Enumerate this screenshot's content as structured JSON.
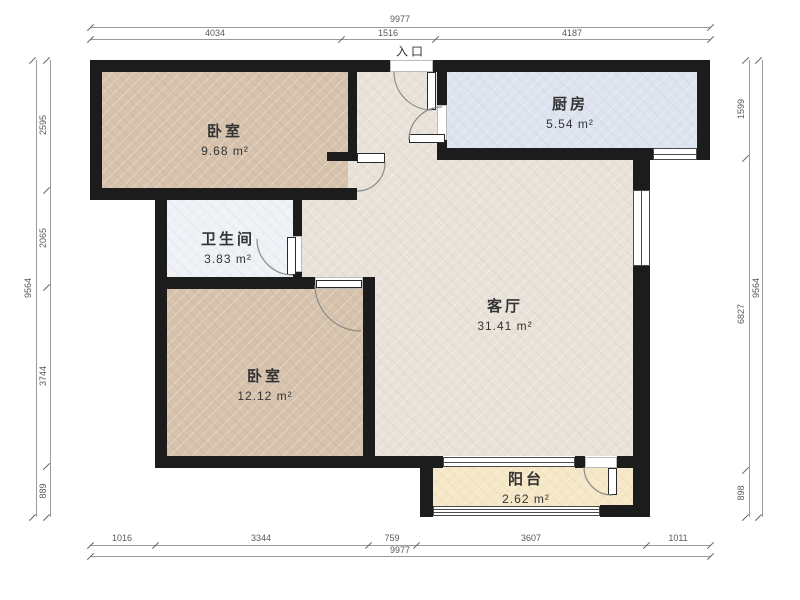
{
  "entrance_label": "入口",
  "rooms": [
    {
      "name": "卧室",
      "area": "9.68 m²"
    },
    {
      "name": "厨房",
      "area": "5.54 m²"
    },
    {
      "name": "卫生间",
      "area": "3.83 m²"
    },
    {
      "name": "客厅",
      "area": "31.41 m²"
    },
    {
      "name": "卧室",
      "area": "12.12 m²"
    },
    {
      "name": "阳台",
      "area": "2.62 m²"
    }
  ],
  "dimensions": {
    "top": {
      "total": "9977",
      "segments": [
        "4034",
        "1516",
        "4187"
      ]
    },
    "bottom": {
      "total": "9977",
      "segments": [
        "1016",
        "3344",
        "759",
        "3607",
        "1011"
      ]
    },
    "left": {
      "total": "9564",
      "segments": [
        "2595",
        "2065",
        "3744",
        "889"
      ]
    },
    "right": {
      "total": "9564",
      "segments": [
        "1599",
        "6827",
        "898"
      ]
    }
  },
  "colors": {
    "wall": "#1c1c1c",
    "bedroom-floor": "#d7c2ac",
    "living-floor": "#e9e2d8",
    "kitchen-floor": "#dde4f0",
    "bath-floor": "#eef2f7",
    "balcony-floor": "#f6e8c7",
    "door-arc": "#8a8a8a",
    "dim-line": "#9a9a9a",
    "dim-text": "#5a5a5a",
    "label-text": "#333333"
  }
}
